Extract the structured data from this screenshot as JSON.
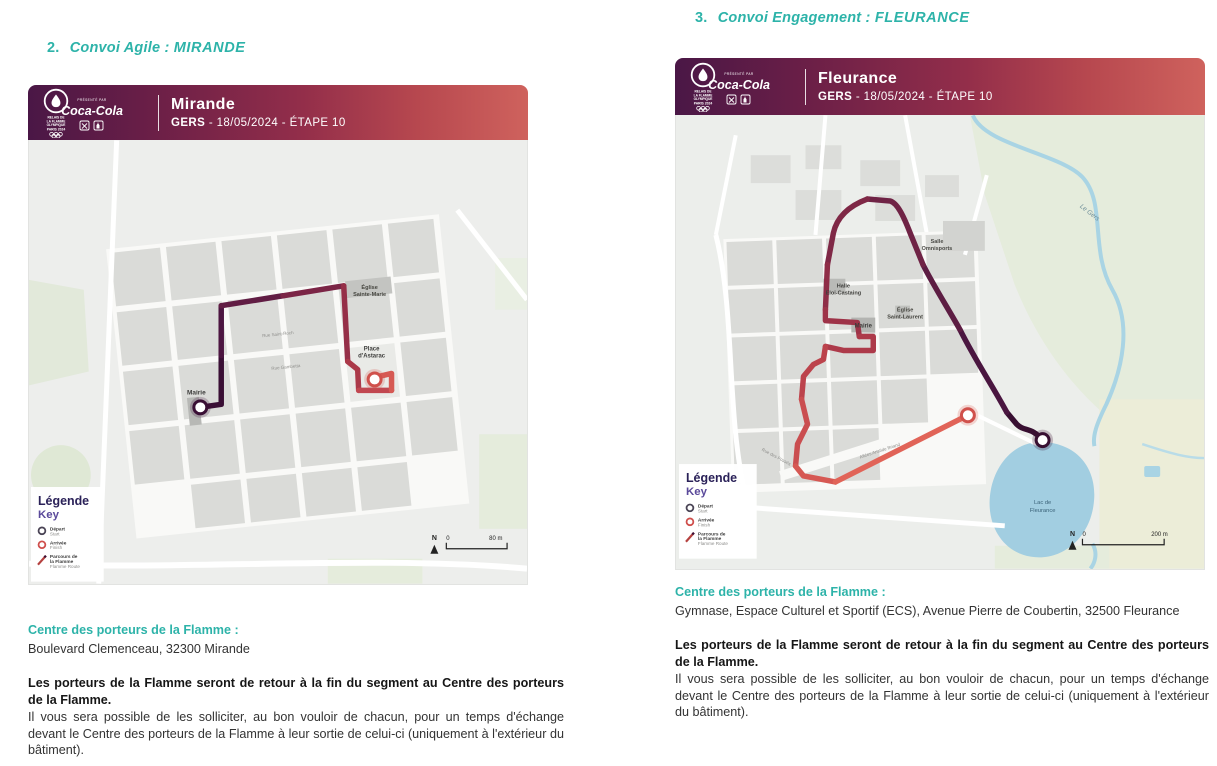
{
  "colors": {
    "accent_teal": "#2db3a9",
    "banner_gradient": [
      "#4a1746",
      "#932e4a",
      "#cf625d"
    ],
    "route_start": "#3a0f35",
    "route_end": "#e16458",
    "legend_title": "#2a2158",
    "legend_key": "#5b4a9b",
    "water": "#a2cee1"
  },
  "legend": {
    "title_fr": "Légende",
    "title_en": "Key",
    "items": [
      {
        "fr": "Départ",
        "en": "Start"
      },
      {
        "fr": "Arrivée",
        "en": "Finish"
      },
      {
        "fr1": "Parcours de",
        "fr2": "la Flamme",
        "en": "Flamme Route"
      }
    ]
  },
  "banner_logo": {
    "relais_l1": "RELAIS DE",
    "relais_l2": "LA FLAMME",
    "relais_l3": "OLYMPIQUE",
    "paris": "PARIS 2024",
    "presented_by": "PRÉSENTÉ PAR",
    "cocacola": "Coca-Cola"
  },
  "sections": {
    "left": {
      "heading": {
        "number": "2.",
        "label": "Convoi Agile :",
        "city": "MIRANDE"
      },
      "banner": {
        "city": "Mirande",
        "dept": "GERS",
        "subtitle": "- 18/05/2024 - ÉTAPE 10"
      },
      "map": {
        "labels": {
          "mairie": "Mairie",
          "eglise_1": "Église",
          "eglise_2": "Sainte-Marie",
          "place_1": "Place",
          "place_2": "d'Astarac",
          "street_1": "Rue Gambetta",
          "street_2": "Rue Saint-Roch"
        },
        "scale": {
          "north": "N",
          "zero": "0",
          "max": "80 m"
        }
      },
      "info": {
        "title": "Centre des porteurs de la Flamme :",
        "address": "Boulevard Clemenceau, 32300 Mirande",
        "bold": "Les porteurs de la Flamme seront de retour à la fin du segment au Centre des porteurs de la Flamme.",
        "body": "Il vous sera possible de les solliciter, au bon vouloir de chacun, pour un temps d'échange devant le Centre des porteurs de la Flamme à leur sortie de celui-ci (uniquement à l'extérieur du bâtiment)."
      }
    },
    "right": {
      "heading": {
        "number": "3.",
        "label": "Convoi Engagement :",
        "city": "FLEURANCE"
      },
      "banner": {
        "city": "Fleurance",
        "dept": "GERS",
        "subtitle": "- 18/05/2024 - ÉTAPE 10"
      },
      "map": {
        "labels": {
          "salle_1": "Salle",
          "salle_2": "Omnisports",
          "halle_1": "Halle",
          "halle_2": "Eloi-Castaing",
          "eglise_1": "Église",
          "eglise_2": "Saint-Laurent",
          "mairie": "Mairie",
          "river": "Le Gers",
          "lake_1": "Lac de",
          "lake_2": "Fleurance",
          "street_1": "Allées Aristide Briand",
          "street_2": "Rue des Fossés"
        },
        "scale": {
          "north": "N",
          "zero": "0",
          "max": "200 m"
        }
      },
      "info": {
        "title": "Centre des porteurs de la Flamme :",
        "address": "Gymnase, Espace Culturel et Sportif (ECS), Avenue Pierre de Coubertin, 32500 Fleurance",
        "bold": "Les porteurs de la Flamme seront de retour à la fin du segment au Centre des porteurs de la Flamme.",
        "body": "Il vous sera possible de les solliciter, au bon vouloir de chacun, pour un temps d'échange devant le Centre des porteurs de la Flamme à leur sortie de celui-ci (uniquement à l'extérieur du bâtiment)."
      }
    }
  }
}
